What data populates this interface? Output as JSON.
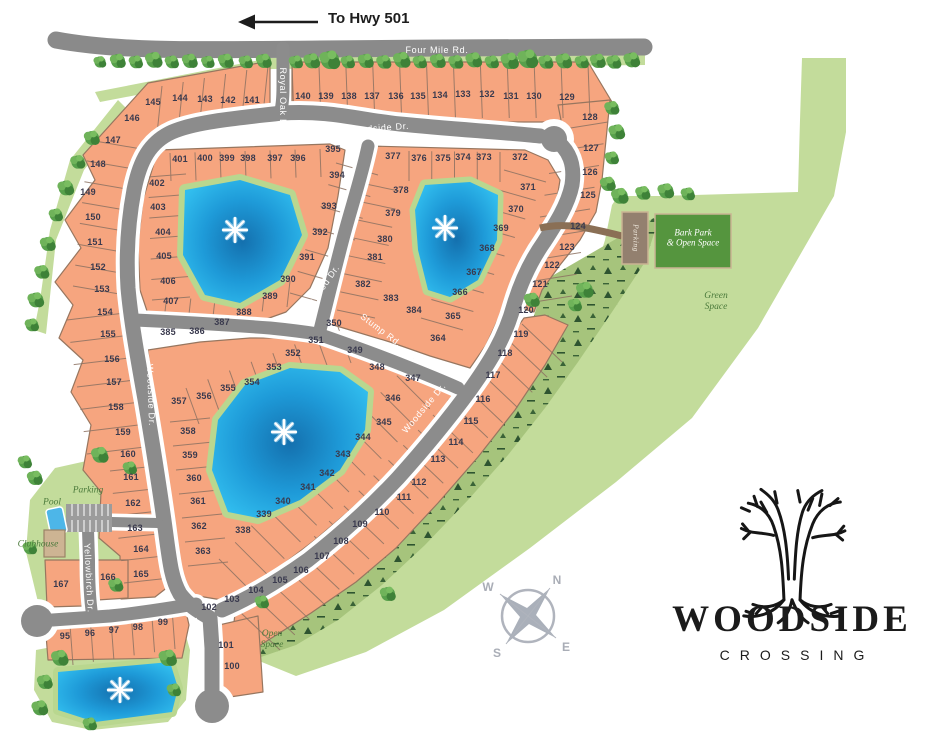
{
  "title": "Woodside Crossing Site Map",
  "header": {
    "arrow_label": "To Hwy 501"
  },
  "compass": {
    "n": "N",
    "w": "W",
    "s": "S",
    "e": "E"
  },
  "logo": {
    "line1": "WOODSIDE",
    "line2": "CROSSING"
  },
  "colors": {
    "lot_fill": "#f6a57f",
    "road_gray": "#8c8c8c",
    "green_light": "#c3dc9b",
    "green_wooded": "#a6c47c",
    "green_dark": "#55953e",
    "pond_blue": "#2fbef0",
    "label_dark": "#3a3a4e",
    "amenity_green": "#4b7a3b"
  },
  "map": {
    "road_labels": [
      {
        "label": "Four Mile Rd.",
        "x": 437,
        "y": 50,
        "rot": 0
      },
      {
        "label": "Royal Oak Dr.",
        "x": 283,
        "y": 100,
        "rot": 90
      },
      {
        "label": "Woodside Dr.",
        "x": 378,
        "y": 128,
        "rot": -4
      },
      {
        "label": "Woodside Dr.",
        "x": 151,
        "y": 395,
        "rot": 88
      },
      {
        "label": "Lightwood Dr.",
        "x": 319,
        "y": 292,
        "rot": -55
      },
      {
        "label": "Stump Rd.",
        "x": 381,
        "y": 330,
        "rot": 37
      },
      {
        "label": "Woodside Dr.",
        "x": 424,
        "y": 408,
        "rot": -50
      },
      {
        "label": "Woodside Dr.",
        "x": 198,
        "y": 649,
        "rot": 82
      },
      {
        "label": "Yellowbirch Dr.",
        "x": 89,
        "y": 578,
        "rot": 87
      }
    ],
    "area_labels": [
      {
        "label": "Parking",
        "x": 88,
        "y": 491,
        "rot": 0,
        "style": "green"
      },
      {
        "label": "Pool",
        "x": 52,
        "y": 503,
        "rot": 0,
        "style": "green"
      },
      {
        "label": "Clubhouse",
        "x": 38,
        "y": 545,
        "rot": 0,
        "style": "green"
      },
      {
        "label": "Bark Park\n& Open Space",
        "x": 693,
        "y": 238,
        "rot": 0,
        "style": "white"
      },
      {
        "label": "Parking",
        "x": 635,
        "y": 238,
        "rot": 90,
        "style": "white-small"
      },
      {
        "label": "Green\nSpace",
        "x": 716,
        "y": 302,
        "rot": 0,
        "style": "green"
      },
      {
        "label": "Open\nSpace",
        "x": 272,
        "y": 640,
        "rot": 0,
        "style": "green"
      }
    ],
    "lots": [
      [
        95,
        65,
        636
      ],
      [
        96,
        90,
        633
      ],
      [
        97,
        114,
        630
      ],
      [
        98,
        138,
        627
      ],
      [
        99,
        163,
        622
      ],
      [
        100,
        232,
        666
      ],
      [
        101,
        226,
        645
      ],
      [
        102,
        209,
        607
      ],
      [
        103,
        232,
        599
      ],
      [
        104,
        256,
        590
      ],
      [
        105,
        280,
        580
      ],
      [
        106,
        301,
        570
      ],
      [
        107,
        322,
        556
      ],
      [
        108,
        341,
        541
      ],
      [
        109,
        360,
        524
      ],
      [
        110,
        382,
        512
      ],
      [
        111,
        404,
        497
      ],
      [
        112,
        419,
        482
      ],
      [
        113,
        438,
        459
      ],
      [
        114,
        456,
        442
      ],
      [
        115,
        471,
        421
      ],
      [
        116,
        483,
        399
      ],
      [
        117,
        493,
        375
      ],
      [
        118,
        505,
        353
      ],
      [
        119,
        521,
        334
      ],
      [
        120,
        526,
        310
      ],
      [
        121,
        540,
        284
      ],
      [
        122,
        552,
        265
      ],
      [
        123,
        567,
        247
      ],
      [
        124,
        578,
        226
      ],
      [
        125,
        588,
        195
      ],
      [
        126,
        590,
        172
      ],
      [
        127,
        591,
        148
      ],
      [
        128,
        590,
        117
      ],
      [
        129,
        567,
        97
      ],
      [
        130,
        534,
        96
      ],
      [
        131,
        511,
        96
      ],
      [
        132,
        487,
        94
      ],
      [
        133,
        463,
        94
      ],
      [
        134,
        440,
        95
      ],
      [
        135,
        418,
        96
      ],
      [
        136,
        396,
        96
      ],
      [
        137,
        372,
        96
      ],
      [
        138,
        349,
        96
      ],
      [
        139,
        326,
        96
      ],
      [
        140,
        303,
        96
      ],
      [
        141,
        252,
        100
      ],
      [
        142,
        228,
        100
      ],
      [
        143,
        205,
        99
      ],
      [
        144,
        180,
        98
      ],
      [
        145,
        153,
        102
      ],
      [
        146,
        132,
        118
      ],
      [
        147,
        113,
        140
      ],
      [
        148,
        98,
        164
      ],
      [
        149,
        88,
        192
      ],
      [
        150,
        93,
        217
      ],
      [
        151,
        95,
        242
      ],
      [
        152,
        98,
        267
      ],
      [
        153,
        102,
        289
      ],
      [
        154,
        105,
        312
      ],
      [
        155,
        108,
        334
      ],
      [
        156,
        112,
        359
      ],
      [
        157,
        114,
        382
      ],
      [
        158,
        116,
        407
      ],
      [
        159,
        123,
        432
      ],
      [
        160,
        128,
        454
      ],
      [
        161,
        131,
        477
      ],
      [
        162,
        133,
        503
      ],
      [
        163,
        135,
        528
      ],
      [
        164,
        141,
        549
      ],
      [
        165,
        141,
        574
      ],
      [
        166,
        108,
        577
      ],
      [
        167,
        61,
        584
      ],
      [
        338,
        243,
        530
      ],
      [
        339,
        264,
        514
      ],
      [
        340,
        283,
        501
      ],
      [
        341,
        308,
        487
      ],
      [
        342,
        327,
        473
      ],
      [
        343,
        343,
        454
      ],
      [
        344,
        363,
        437
      ],
      [
        345,
        384,
        422
      ],
      [
        346,
        393,
        398
      ],
      [
        347,
        413,
        378
      ],
      [
        348,
        377,
        367
      ],
      [
        349,
        355,
        350
      ],
      [
        350,
        334,
        323
      ],
      [
        351,
        316,
        340
      ],
      [
        352,
        293,
        353
      ],
      [
        353,
        274,
        367
      ],
      [
        354,
        252,
        382
      ],
      [
        355,
        228,
        388
      ],
      [
        356,
        204,
        396
      ],
      [
        357,
        179,
        401
      ],
      [
        358,
        188,
        431
      ],
      [
        359,
        190,
        455
      ],
      [
        360,
        194,
        478
      ],
      [
        361,
        198,
        501
      ],
      [
        362,
        199,
        526
      ],
      [
        363,
        203,
        551
      ],
      [
        364,
        438,
        338
      ],
      [
        365,
        453,
        316
      ],
      [
        366,
        460,
        292
      ],
      [
        367,
        474,
        272
      ],
      [
        368,
        487,
        248
      ],
      [
        369,
        501,
        228
      ],
      [
        370,
        516,
        209
      ],
      [
        371,
        528,
        187
      ],
      [
        372,
        520,
        157
      ],
      [
        373,
        484,
        157
      ],
      [
        374,
        463,
        157
      ],
      [
        375,
        443,
        158
      ],
      [
        376,
        419,
        158
      ],
      [
        377,
        393,
        156
      ],
      [
        378,
        401,
        190
      ],
      [
        379,
        393,
        213
      ],
      [
        380,
        385,
        239
      ],
      [
        381,
        375,
        257
      ],
      [
        382,
        363,
        284
      ],
      [
        383,
        391,
        298
      ],
      [
        384,
        414,
        310
      ],
      [
        385,
        168,
        332
      ],
      [
        386,
        197,
        331
      ],
      [
        387,
        222,
        322
      ],
      [
        388,
        244,
        312
      ],
      [
        389,
        270,
        296
      ],
      [
        390,
        288,
        279
      ],
      [
        391,
        307,
        257
      ],
      [
        392,
        320,
        232
      ],
      [
        393,
        329,
        206
      ],
      [
        394,
        337,
        175
      ],
      [
        395,
        333,
        149
      ],
      [
        396,
        298,
        158
      ],
      [
        397,
        275,
        158
      ],
      [
        398,
        248,
        158
      ],
      [
        399,
        227,
        158
      ],
      [
        400,
        205,
        158
      ],
      [
        401,
        180,
        159
      ],
      [
        402,
        157,
        183
      ],
      [
        403,
        158,
        207
      ],
      [
        404,
        163,
        232
      ],
      [
        405,
        164,
        256
      ],
      [
        406,
        168,
        281
      ],
      [
        407,
        171,
        301
      ]
    ]
  }
}
